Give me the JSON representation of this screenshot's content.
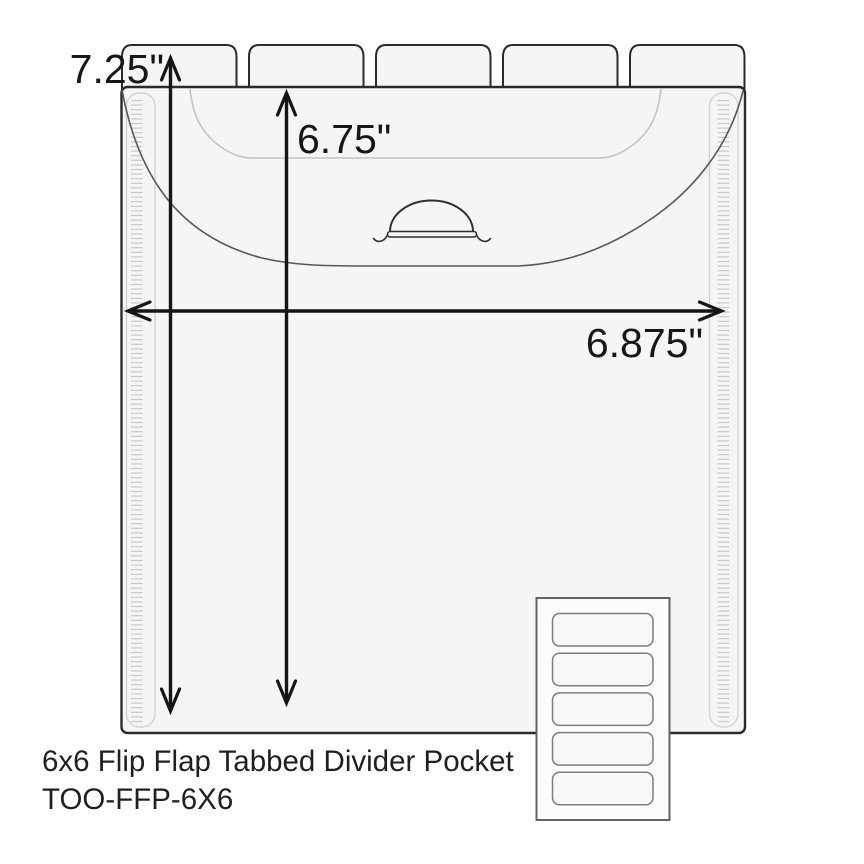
{
  "diagram": {
    "dimensions": {
      "total_height": "7.25\"",
      "pocket_height": "6.75\"",
      "width": "6.875\""
    },
    "product": {
      "title": "6x6 Flip Flap Tabbed Divider Pocket",
      "sku": "TOO-FFP-6X6"
    },
    "tabs": {
      "count": 5
    },
    "inset": {
      "slot_count": 5
    },
    "colors": {
      "outline": "#2b2b2b",
      "body_fill": "#f5f5f6",
      "flap_line": "#585858",
      "inner_line": "#c4c4c4",
      "binding_line": "#d2d2d2",
      "stitch": "#c8c8c8",
      "arrow": "#151515",
      "inset_border": "#636363",
      "slot_border": "#7d7d7d",
      "inset_fill": "#fcfcfc",
      "slot_fill": "#f8f8f8"
    }
  }
}
